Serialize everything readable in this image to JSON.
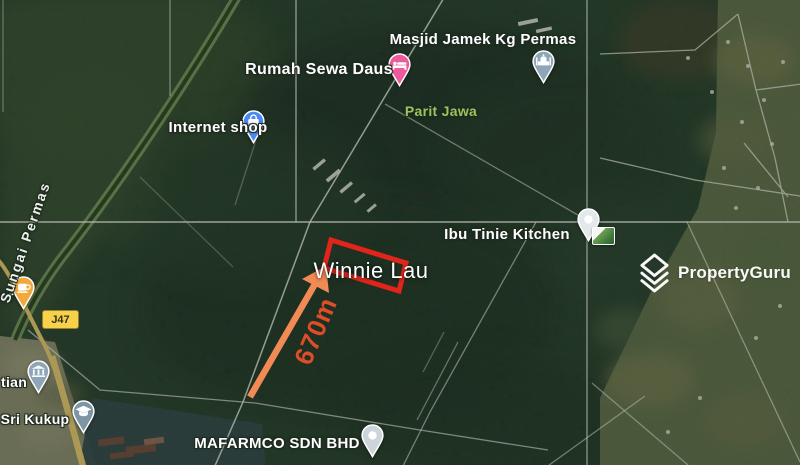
{
  "watermark": {
    "brand": "PropertyGuru"
  },
  "map": {
    "place_labels": {
      "masjid_jamek": "Masjid Jamek Kg Permas",
      "rumah_sewa": "Rumah Sewa Daus",
      "internet_shop": "Internet shop",
      "parit_jawa": "Parit Jawa",
      "ibu_tinie": "Ibu Tinie Kitchen",
      "mafarmco": "MAFARMCO SDN BHD",
      "sri_kukup": "Sri Kukup",
      "left_edge_partial_top": "tian",
      "left_edge_partial_mid": "er"
    },
    "river_label": "Sungai Permas",
    "road_badge": "J47",
    "annotations": {
      "name": "Winnie Lau",
      "distance": "670m"
    },
    "colors": {
      "boundary_red": "#e2251b",
      "arrow_orange": "#f28a56",
      "distance_text": "#dd4d27",
      "locality_green": "#9cc45c",
      "badge_yellow": "#f8d14b",
      "road_yellow": "#e9c86d"
    },
    "pins": {
      "lodging": {
        "color": "#ee5a9b"
      },
      "shopping": {
        "color": "#4a8af4"
      },
      "mosque": {
        "color": "#8fa6b8"
      },
      "kitchen": {
        "color": "#e3e8ea"
      },
      "cafe": {
        "color": "#f2a93b"
      },
      "civic": {
        "color": "#8fa6b8"
      },
      "school": {
        "color": "#7e95a6"
      },
      "generic": {
        "color": "#ccd5d9"
      }
    }
  }
}
